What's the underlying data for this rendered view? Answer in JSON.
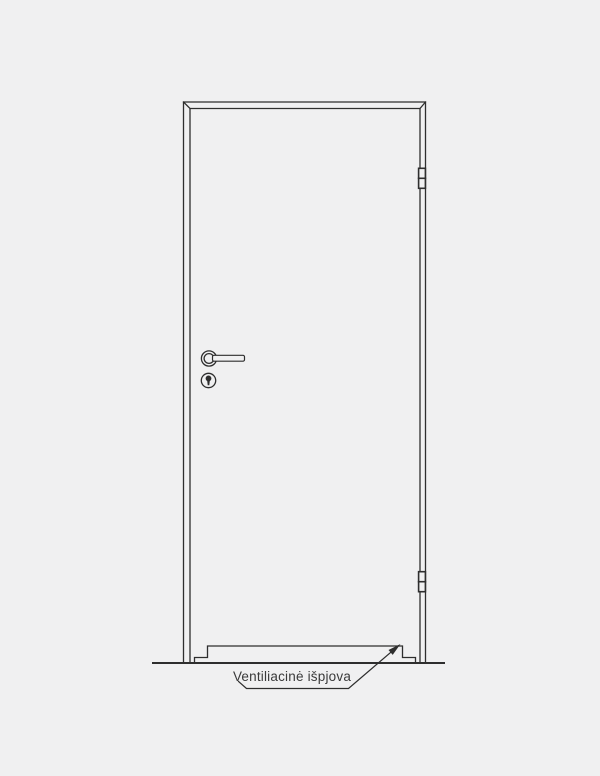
{
  "colors": {
    "background": "#f0f0f1",
    "line": "#2e2e2e",
    "floor_line": "#3a3a3a",
    "text": "#3a3a3a"
  },
  "label": {
    "text": "Ventiliacinė išpjova"
  }
}
